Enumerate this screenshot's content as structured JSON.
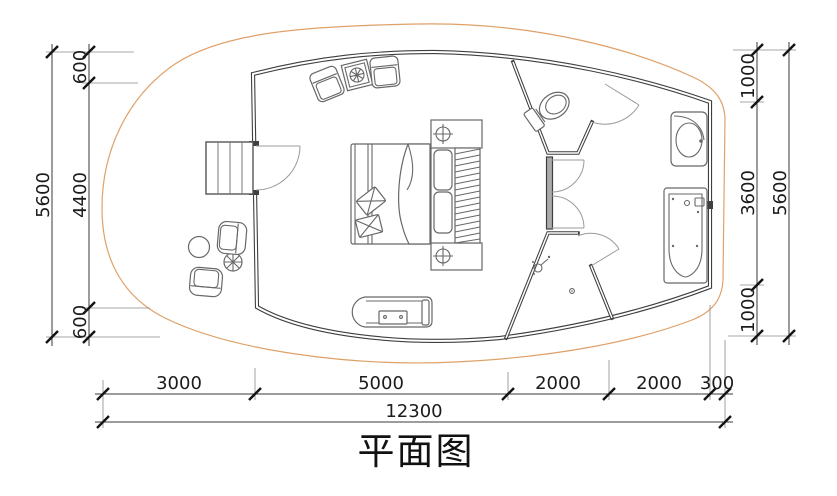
{
  "title": "平面图",
  "drawing_type": "floor-plan",
  "colors": {
    "wall_line": "#3f3f3f",
    "furniture_line": "#686868",
    "deck_hatch": "#e8a76d",
    "dimension_text": "#1c1c1c"
  },
  "dimensions": {
    "left": {
      "overall": "5600",
      "segments": [
        "600",
        "4400",
        "600"
      ]
    },
    "right": {
      "overall": "5600",
      "segments": [
        "1000",
        "3600",
        "1000"
      ]
    },
    "bottom": {
      "overall": "12300",
      "segments": [
        "3000",
        "5000",
        "2000",
        "2000",
        "300"
      ]
    }
  }
}
